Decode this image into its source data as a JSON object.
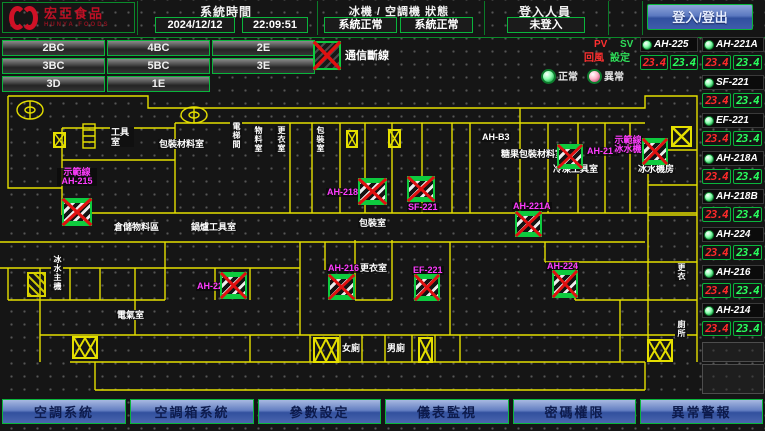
{
  "header": {
    "logo_title": "宏亞食品",
    "logo_subtitle": "HUNYA FOODS",
    "time_section_label": "系統時間",
    "date_value": "2024/12/12",
    "time_value": "22:09:51",
    "status_section_label": "冰機 / 空調機 狀態",
    "chiller_status": "系統正常",
    "ac_status": "系統正常",
    "login_section_label": "登入人員",
    "login_status": "未登入",
    "login_button_label": "登入/登出"
  },
  "zones": [
    "2BC",
    "4BC",
    "2E",
    "3BC",
    "5BC",
    "3E",
    "3D",
    "1E"
  ],
  "legend": {
    "comm_fault_label": "通信斷線",
    "pv": "PV",
    "sv": "SV",
    "pv_column": "回風",
    "sv_column": "設定",
    "normal": "正常",
    "abnormal": "異常"
  },
  "units": [
    {
      "name": "AH-225",
      "pv": "23.4",
      "sv": "23.4"
    },
    {
      "name": "AH-221A",
      "pv": "23.4",
      "sv": "23.4"
    },
    {
      "name": "SF-221",
      "pv": "23.4",
      "sv": "23.4"
    },
    {
      "name": "EF-221",
      "pv": "23.4",
      "sv": "23.4"
    },
    {
      "name": "AH-218A",
      "pv": "23.4",
      "sv": "23.4"
    },
    {
      "name": "AH-218B",
      "pv": "23.4",
      "sv": "23.4"
    },
    {
      "name": "AH-224",
      "pv": "23.4",
      "sv": "23.4"
    },
    {
      "name": "AH-216",
      "pv": "23.4",
      "sv": "23.4"
    },
    {
      "name": "AH-214",
      "pv": "23.4",
      "sv": "23.4"
    }
  ],
  "plan": {
    "rooms": [
      {
        "text": "工具室"
      },
      {
        "text": "包裝材料室"
      },
      {
        "text": "電梯間"
      },
      {
        "text": "AH-B3"
      },
      {
        "text": "糖果包裝材料室"
      },
      {
        "text": "冷凍工具室"
      },
      {
        "text": "冰水機房"
      },
      {
        "text": "包裝室"
      },
      {
        "text": "更衣室"
      },
      {
        "text": "女廁"
      },
      {
        "text": "男廁"
      },
      {
        "text": "倉儲物料區"
      },
      {
        "text": "鍋爐工具室"
      },
      {
        "text": "冰水主機"
      },
      {
        "text": "電氣室"
      },
      {
        "text": "更衣"
      },
      {
        "text": "廁所"
      },
      {
        "text": "物料室"
      },
      {
        "text": "更衣室"
      },
      {
        "text": "包裝室"
      }
    ],
    "ahus": [
      {
        "label": "示範線\nAH-215"
      },
      {
        "label": "AH-218A"
      },
      {
        "label": "SF-221"
      },
      {
        "label": "AH-221A"
      },
      {
        "label": "AH-214"
      },
      {
        "label": "示範線\n冰水機"
      },
      {
        "label": "AH-216"
      },
      {
        "label": "EF-221"
      },
      {
        "label": "AH-224"
      },
      {
        "label": "AH-225"
      }
    ]
  },
  "nav": [
    "空調系統",
    "空調箱系統",
    "參數設定",
    "儀表監視",
    "密碼權限",
    "異常警報"
  ],
  "colors": {
    "accent_green": "#0ab53c",
    "alarm_red": "#e01010",
    "label_magenta": "#ff3cff",
    "wall_yellow": "#e4de00",
    "button_blue": "#4a66ae",
    "pv_red": "#ff2a2a",
    "sv_green": "#2aff5e"
  }
}
